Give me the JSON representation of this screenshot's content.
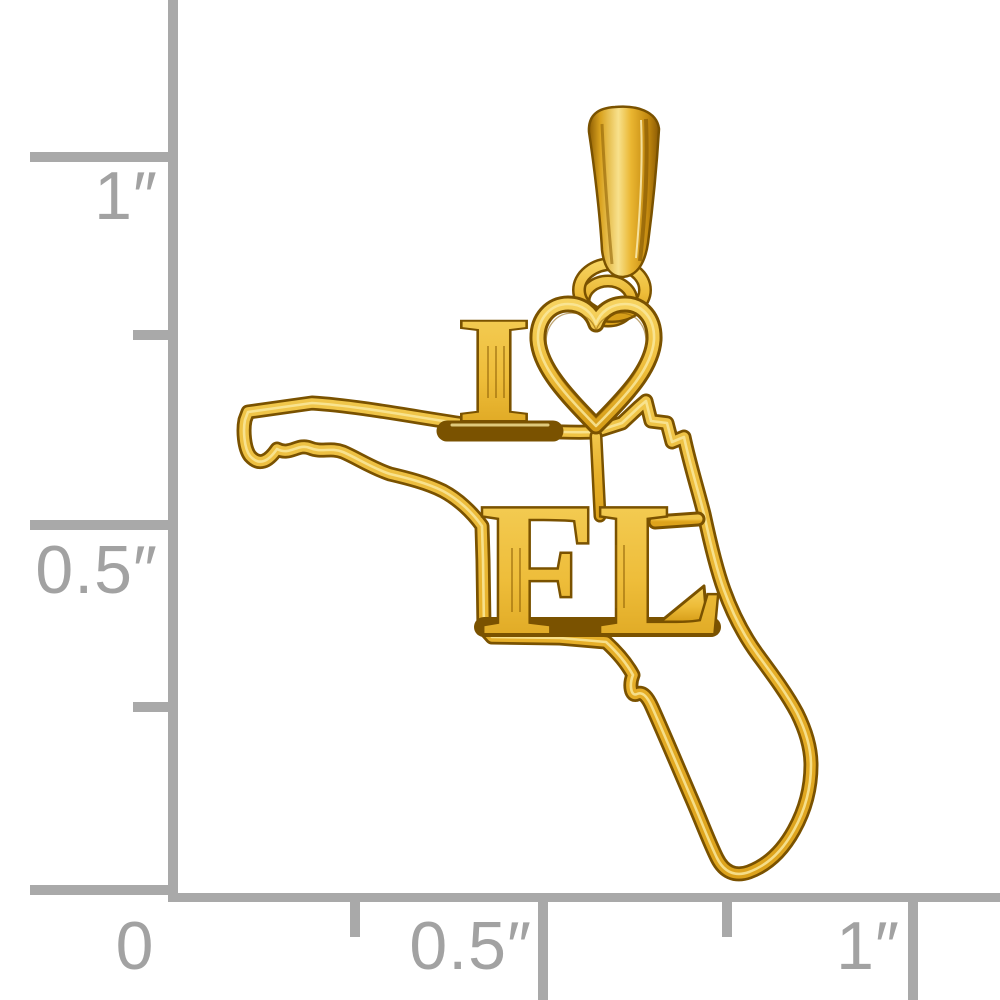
{
  "background_color": "#ffffff",
  "ruler": {
    "color": "#a9a9a9",
    "label_color": "#a2a2a2",
    "left_axis": {
      "one_inch_label": "1″",
      "half_inch_label": "0.5″"
    },
    "bottom_axis": {
      "zero_label": "0",
      "half_inch_label": "0.5″",
      "one_inch_label": "1″"
    }
  },
  "pendant": {
    "kind": "yellow-gold Florida state cut-out charm pendant with bail",
    "engraving": {
      "letter_i": "I",
      "heart": "♥",
      "state_abbr": "FL"
    },
    "gold_colors": {
      "dark_edge": "#7a5200",
      "mid": "#e8b42f",
      "face": "#f2c84c",
      "bright": "#f8e18c",
      "highlight": "#fdf3c7"
    }
  }
}
